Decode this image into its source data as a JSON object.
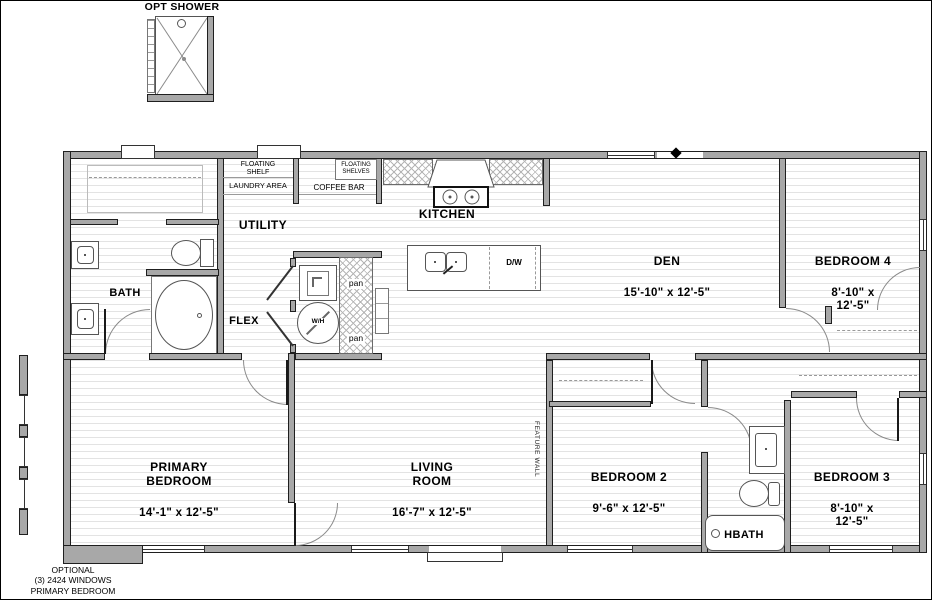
{
  "annotations": {
    "opt_shower": "OPT SHOWER",
    "optional_caption": "OPTIONAL\n(3) 2424 WINDOWS\nPRIMARY BEDROOM",
    "feature_wall": "FEATURE WALL"
  },
  "rooms": {
    "utility": {
      "name": "UTILITY"
    },
    "bath": {
      "name": "BATH"
    },
    "flex": {
      "name": "FLEX"
    },
    "kitchen": {
      "name": "KITCHEN"
    },
    "den": {
      "name": "DEN",
      "dims": "15'-10\" x  12'-5\""
    },
    "bedroom4": {
      "name": "BEDROOM 4",
      "dims": "8'-10\" x  12'-5\""
    },
    "primary": {
      "name": "PRIMARY\nBEDROOM",
      "dims": "14'-1\" x  12'-5\""
    },
    "living": {
      "name": "LIVING\nROOM",
      "dims": "16'-7\" x  12'-5\""
    },
    "bedroom2": {
      "name": "BEDROOM 2",
      "dims": "9'-6\" x  12'-5\""
    },
    "bedroom3": {
      "name": "BEDROOM 3",
      "dims": "8'-10\" x  12'-5\""
    },
    "hbath": {
      "name": "HBATH"
    }
  },
  "features": {
    "floating_shelf": "FLOATING\nSHELF",
    "laundry_area": "LAUNDRY AREA",
    "coffee_bar": "COFFEE BAR",
    "floating_shelves": "FLOATING\nSHELVES",
    "dishwasher": "D/W",
    "pantry_top": "pan",
    "pantry_bottom": "pan",
    "water_heater": "W/H"
  },
  "colors": {
    "wall_fill": "#a8a8a8",
    "outline": "#1f1f1f",
    "floor_line": "#e3e3e3",
    "text": "#000000"
  }
}
